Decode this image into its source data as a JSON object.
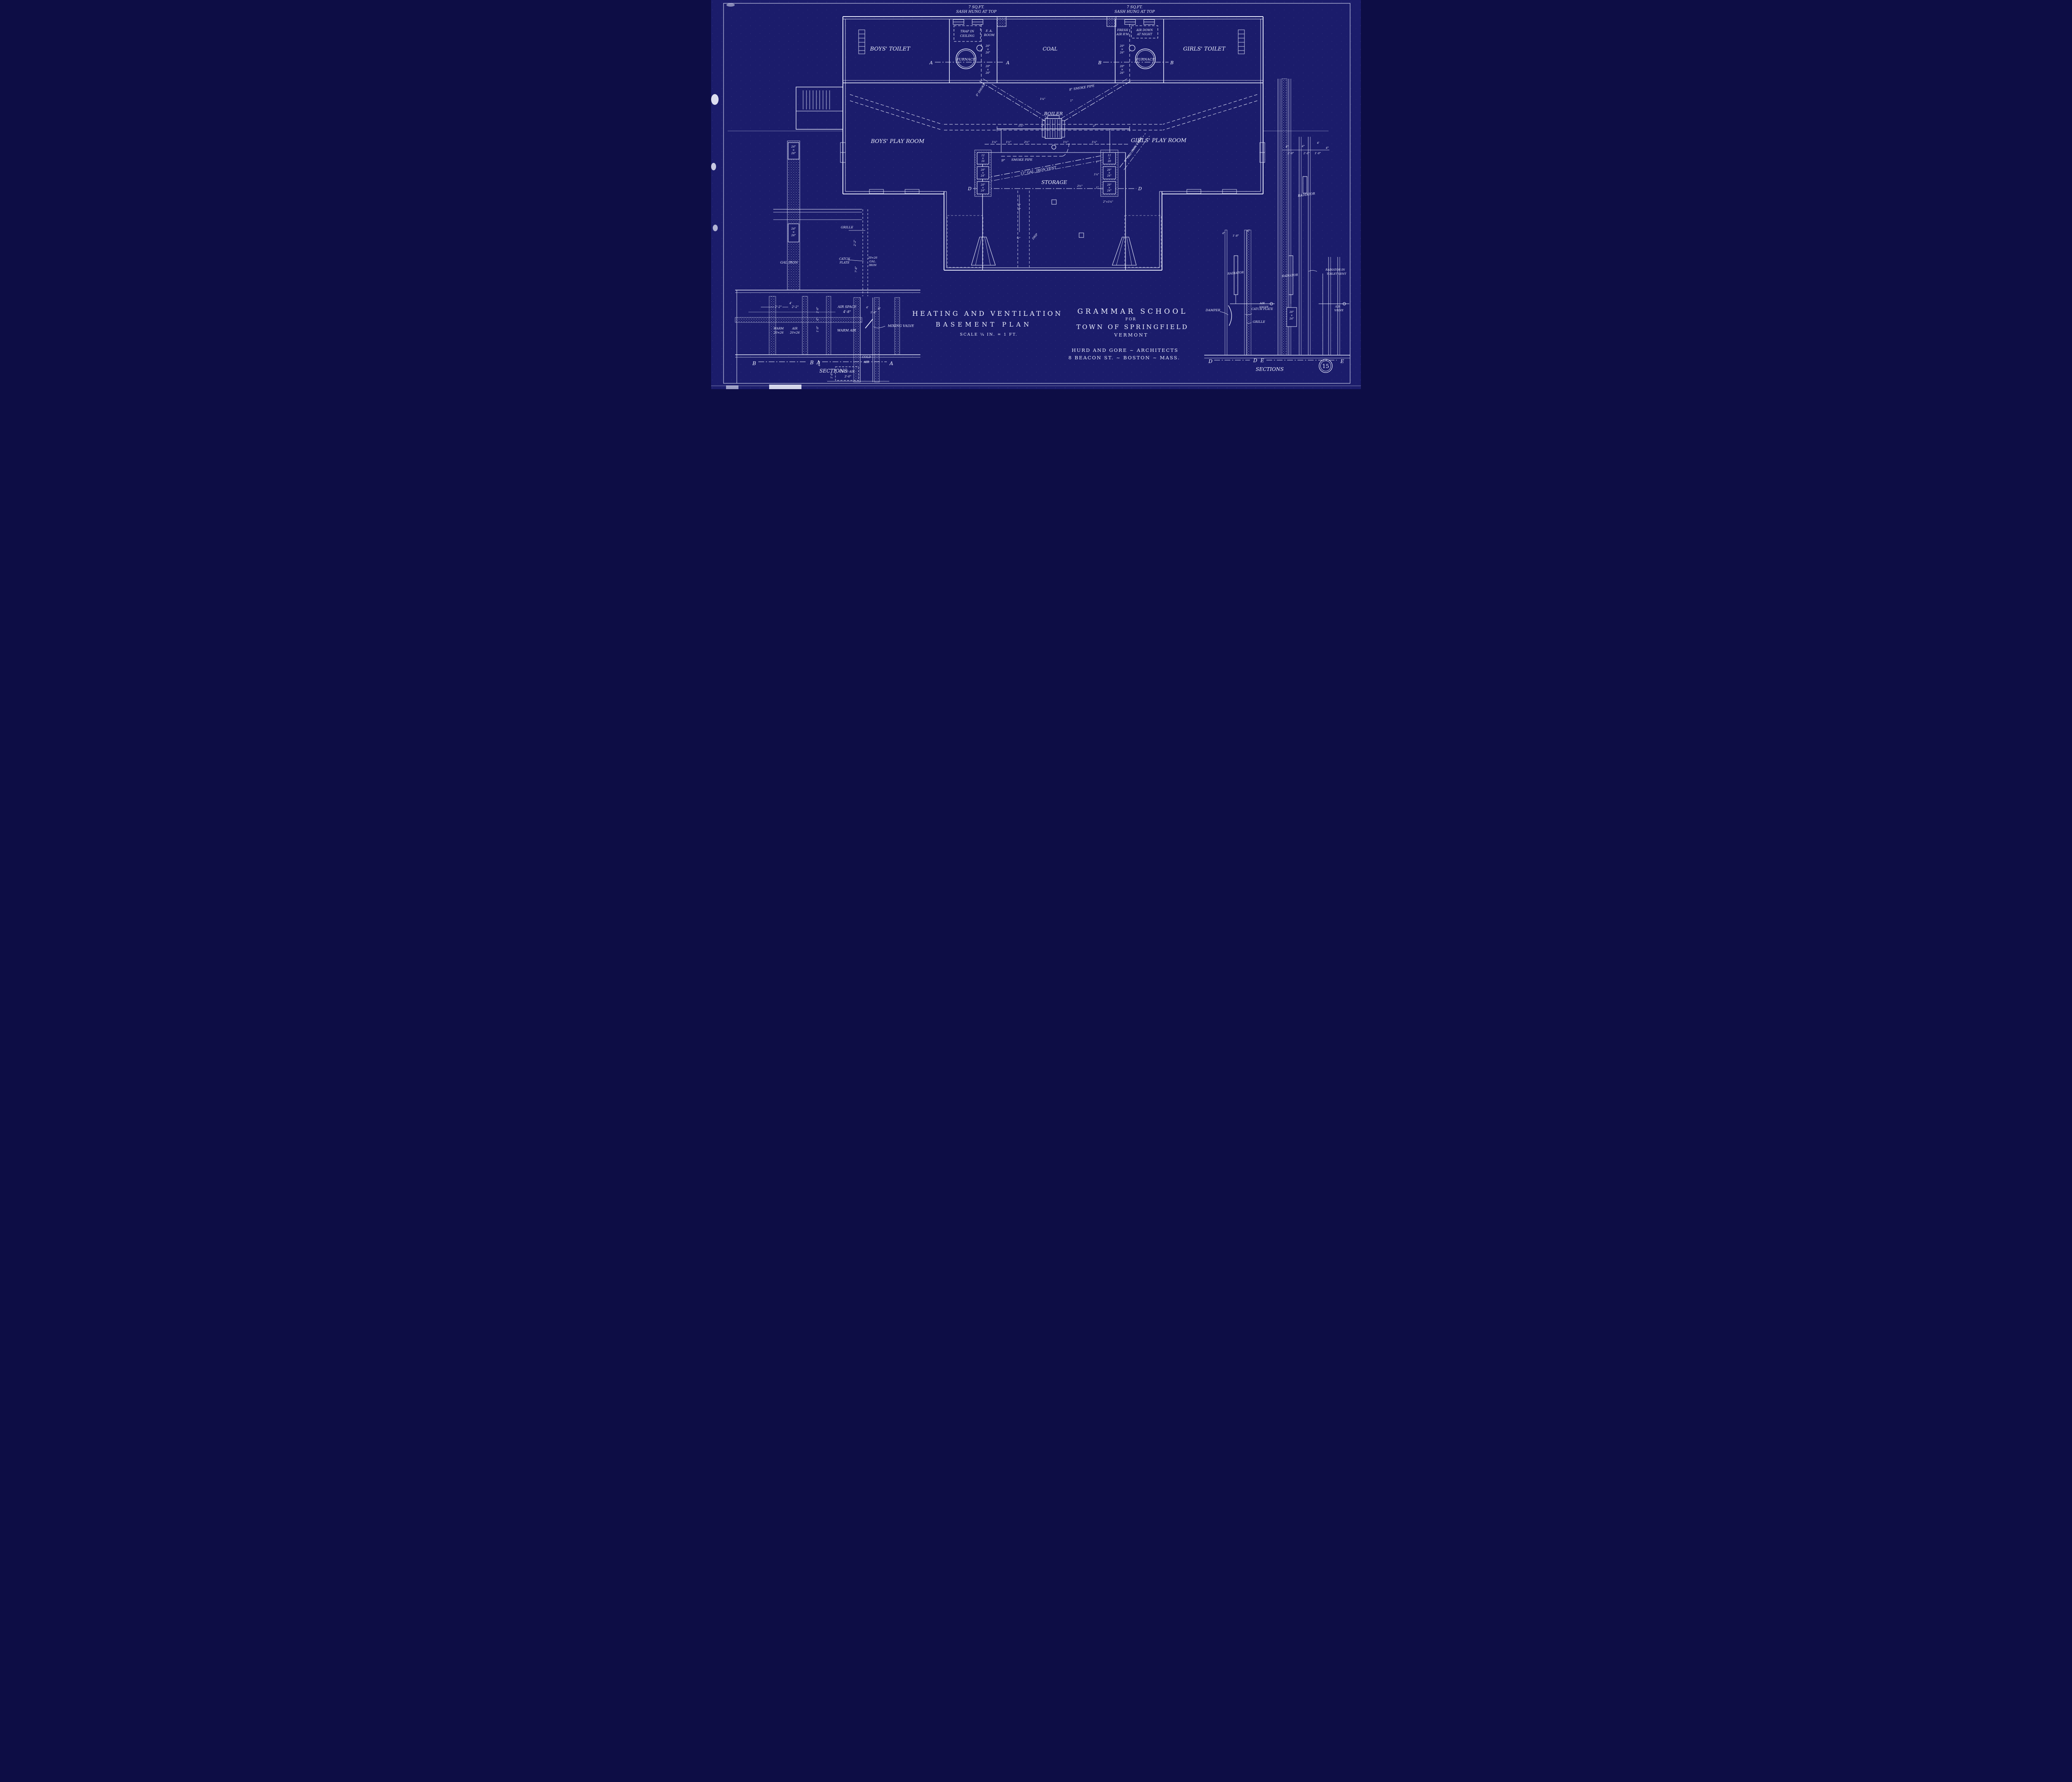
{
  "sheet": {
    "number": "15"
  },
  "title": {
    "l1": "HEATING AND VENTILATION",
    "l2": "BASEMENT PLAN",
    "scale": "SCALE ¼ IN. = 1 FT."
  },
  "project": {
    "l1": "GRAMMAR SCHOOL",
    "l2": "FOR",
    "l3": "TOWN OF SPRINGFIELD",
    "l4": "VERMONT",
    "a1": "HURD AND GORE ~ ARCHITECTS",
    "a2": "8 BEACON ST. ~ BOSTON ~ MASS."
  },
  "rooms": {
    "boys_toilet": "BOYS' TOILET",
    "girls_toilet": "GIRLS' TOILET",
    "coal": "COAL",
    "boys_play": "BOYS' PLAY ROOM",
    "girls_play": "GIRLS' PLAY ROOM",
    "storage": "STORAGE"
  },
  "equipment": {
    "furnace": "FURNACE",
    "boiler": "BOILER",
    "radiator": "RADIATOR",
    "radiator_in_1": "RADIATOR IN",
    "radiator_in_2": "TOILET VENT",
    "damper": "DAMPER",
    "catch_plate": "CATCH PLATE",
    "catch_1": "CATCH",
    "catch_2": "PLATE",
    "grille": "GRILLE",
    "mixing_valve": "MIXING VALVE",
    "air_valve_1": "AIR",
    "air_valve_2": "VALVE",
    "gal_iron": "GAL IRON",
    "warm_air": "WARM AIR",
    "warm_1": "WARM",
    "air_1": "AIR",
    "cold_1": "COLD",
    "cold_2": "AIR",
    "cold_air": "COLD AIR",
    "air_space": "AIR SPACE"
  },
  "notes": {
    "sash_1": "7 SQ.FT.",
    "sash_2": "SASH HUNG AT TOP",
    "trap_1": "TRAP IN",
    "trap_2": "CEILING",
    "fa_1": "F. A.",
    "fa_2": "ROOM",
    "fresh_1": "FRESH",
    "fresh_2": "AIR R'M",
    "down_1": "AIR DOWN",
    "down_2": "AT NIGHT"
  },
  "pipes": {
    "smoke8": "8\" SMOKE",
    "smoke8_pipe": "8\" SMOKE PIPE",
    "nine": "9\"",
    "smoke_pipe": "SMOKE PIPE",
    "vent12": "12\" GAL. IRON VENT",
    "vent9": "9\" GAL IRON VENT",
    "drip": "DRIP"
  },
  "sections": {
    "a": "A",
    "b": "B",
    "d": "D",
    "e": "E",
    "label": "SECTIONS"
  },
  "sizes": {
    "s2026": [
      "20\"",
      "×",
      "26\""
    ],
    "s2024": [
      "20\"",
      "×",
      "24\""
    ],
    "s2426": [
      "24\"",
      "×",
      "26\""
    ],
    "s1216": [
      "12",
      "×",
      "16"
    ],
    "s1220": [
      "12",
      "×",
      "20"
    ],
    "gal2026": [
      "20×26",
      "GAL.",
      "IRON"
    ],
    "w2026": "20×26",
    "seat": "2\"×1¼\""
  },
  "dims": {
    "half": "½\"",
    "one": "1\"",
    "one14": "1¼\"",
    "one12": "1½\"",
    "two": "2\"",
    "two12": "2½\"",
    "ft2_2": "2'-2\"",
    "ft4": "4'",
    "in4": "4\"",
    "ft4_8": "4'-8\"",
    "ft1_8": "1'-8\"",
    "in8": "8\"",
    "ft2_6": "2'-6\"",
    "in6": "6\"",
    "ft4_4": "4'-4\"",
    "ft3_0": "3'-0\"",
    "ft1_0": "1'-0\"",
    "ft2_0": "2'-0\"",
    "ft7_6": "7'-6\""
  }
}
